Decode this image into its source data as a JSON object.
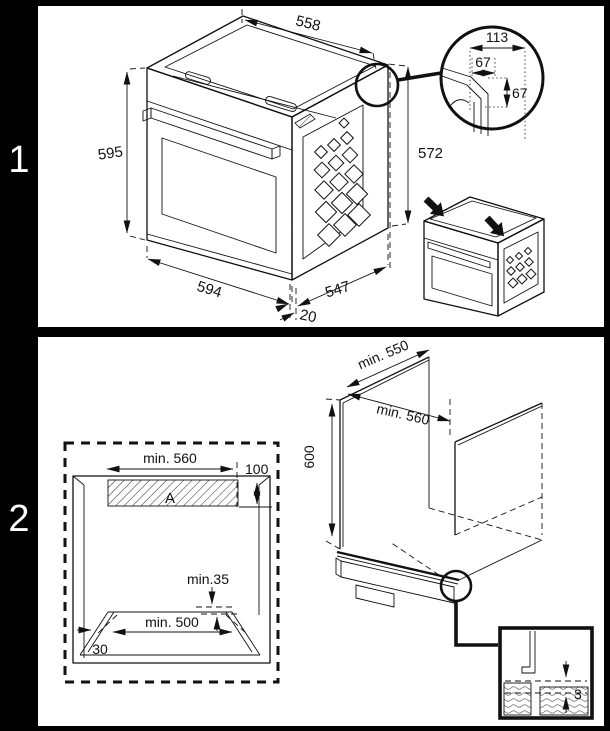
{
  "page": {
    "step_labels": [
      "1",
      "2"
    ]
  },
  "panel1": {
    "dims": {
      "top_width": "558",
      "front_height": "595",
      "side_height": "572",
      "bottom_width": "594",
      "depth": "547",
      "bottom_offset": "20"
    },
    "corner_detail": {
      "total_width": "113",
      "cutout_width": "67",
      "cutout_height": "67"
    }
  },
  "panel2": {
    "niche_front": {
      "top_width": "min. 560",
      "vent_depth": "100",
      "vent_area_label": "A",
      "rear_clearance": "min.35",
      "base_width": "min. 500",
      "side_clearance": "30"
    },
    "niche_perspective": {
      "depth": "min. 550",
      "width": "min. 560",
      "height": "600"
    },
    "panel_gap_detail": {
      "gap": "3"
    }
  }
}
